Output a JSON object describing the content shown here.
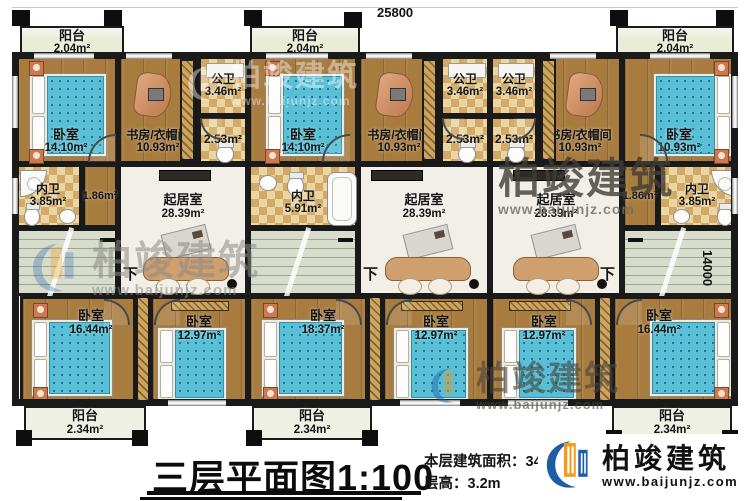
{
  "dimensions": {
    "top": "25800",
    "right": "14000"
  },
  "stairs": {
    "down": "下"
  },
  "watermark": {
    "brand": "柏竣建筑",
    "url": "www.baijunjz.com"
  },
  "logo": {
    "brand": "柏竣建筑",
    "url": "www.baijunjz.com"
  },
  "title": {
    "text": "三层平面图",
    "scale": "1:100",
    "area_label": "本层建筑面积：",
    "area_value": "343.55m²",
    "height_label": "层高：",
    "height_value": "3.2m"
  },
  "colors": {
    "wall": "#1a1a1a",
    "wood": "#a87c3f",
    "tile": "#d2a966",
    "living": "#f1efe8",
    "stairs": "#d7dccd",
    "balcony": "#e9edd8",
    "bed": "#58bfd6",
    "logo_blue": "#1d5da7",
    "logo_orange": "#f3991c"
  },
  "rooms": {
    "u1_balcony_top": {
      "label": "阳台",
      "area": "2.04m²"
    },
    "u1_bedroom_top": {
      "label": "卧室",
      "area": "14.10m²"
    },
    "u1_study": {
      "label": "书房/衣帽间",
      "area": "10.93m²"
    },
    "u1_gongwei": {
      "label": "公卫",
      "area": "3.46m²"
    },
    "u1_bath253": {
      "area": "2.53m²"
    },
    "u1_neiwei": {
      "label": "内卫",
      "area": "3.85m²"
    },
    "u1_hall": {
      "area": "1.86m²"
    },
    "u1_living": {
      "label": "起居室",
      "area": "28.39m²"
    },
    "u1_bedroom_b1": {
      "label": "卧室",
      "area": "16.44m²"
    },
    "u1_bedroom_b2": {
      "label": "卧室",
      "area": "12.97m²"
    },
    "u1_balcony_bottom": {
      "label": "阳台",
      "area": "2.34m²"
    },
    "u2_balcony_top": {
      "label": "阳台",
      "area": "2.04m²"
    },
    "u2_bedroom_top": {
      "label": "卧室",
      "area": "14.10m²"
    },
    "u2_study": {
      "label": "书房/衣帽间",
      "area": "10.93m²"
    },
    "u2_gongwei": {
      "label": "公卫",
      "area": "3.46m²"
    },
    "u2_bath253": {
      "area": "2.53m²"
    },
    "u2_neiwei": {
      "label": "内卫",
      "area": "5.91m²"
    },
    "u2_living": {
      "label": "起居室",
      "area": "28.39m²"
    },
    "u2_bedroom_b1": {
      "label": "卧室",
      "area": "18.37m²"
    },
    "u2_bedroom_b2": {
      "label": "卧室",
      "area": "12.97m²"
    },
    "u2_balcony_bottom": {
      "label": "阳台",
      "area": "2.34m²"
    },
    "u3_gongwei": {
      "label": "公卫",
      "area": "3.46m²"
    },
    "u3_bath253": {
      "area": "2.53m²"
    },
    "u3_study": {
      "label": "书房/衣帽间",
      "area": "10.93m²"
    },
    "u3_bedroom_top": {
      "label": "卧室",
      "area": "10.93m²"
    },
    "u3_balcony_top": {
      "label": "阳台",
      "area": "2.04m²"
    },
    "u3_hall": {
      "area": "1.86m²"
    },
    "u3_neiwei": {
      "label": "内卫",
      "area": "3.85m²"
    },
    "u3_living": {
      "label": "起居室",
      "area": "28.39m²"
    },
    "u3_bedroom_b1": {
      "label": "卧室",
      "area": "12.97m²"
    },
    "u3_bedroom_b2": {
      "label": "卧室",
      "area": "16.44m²"
    },
    "u3_balcony_bottom": {
      "label": "阳台",
      "area": "2.34m²"
    }
  }
}
